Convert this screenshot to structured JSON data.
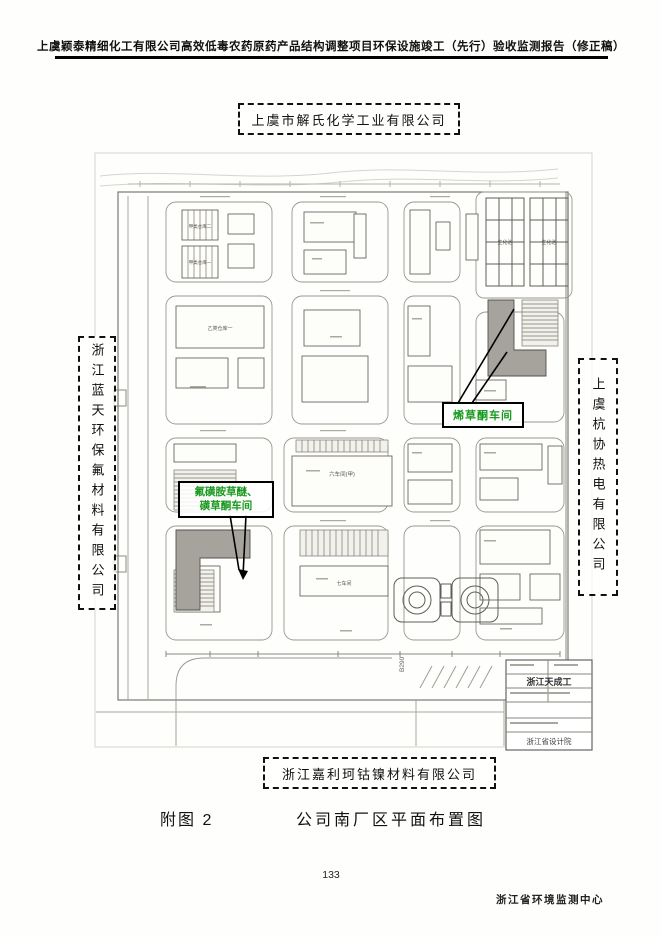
{
  "header": {
    "title": "上虞颖泰精细化工有限公司高效低毒农药原药产品结构调整项目环保设施竣工（先行）验收监测报告（修正稿）"
  },
  "neighbors": {
    "top": "上虞市解氏化学工业有限公司",
    "left": "浙江蓝天环保氟材料有限公司",
    "right": "上虞杭协热电有限公司",
    "bottom": "浙江嘉利珂钴镍材料有限公司"
  },
  "map": {
    "highlights": {
      "left_line1": "氟磺胺草醚、",
      "left_line2": "磺草酮车间",
      "right_label": "烯草酮车间"
    },
    "annotations": {
      "pond1": "生化池",
      "pond2": "生化池",
      "warehouse_a2": "甲类仓库二",
      "warehouse_a1": "甲类仓库一",
      "warehouse_b1": "乙类仓库一",
      "workshop6": "六车间(甲)",
      "workshop7": "七车间",
      "road_code": "B290"
    },
    "title_block": {
      "stamp1": "浙江天成工",
      "stamp2": "浙江省设计院"
    }
  },
  "caption": {
    "figure_no": "附图 2",
    "title": "公司南厂区平面布置图"
  },
  "footer": {
    "page_number": "133",
    "org": "浙江省环境监测中心"
  },
  "colors": {
    "highlight_green": "#17991d",
    "building_gray": "#a5a39c",
    "ink": "#1a1a1a"
  }
}
